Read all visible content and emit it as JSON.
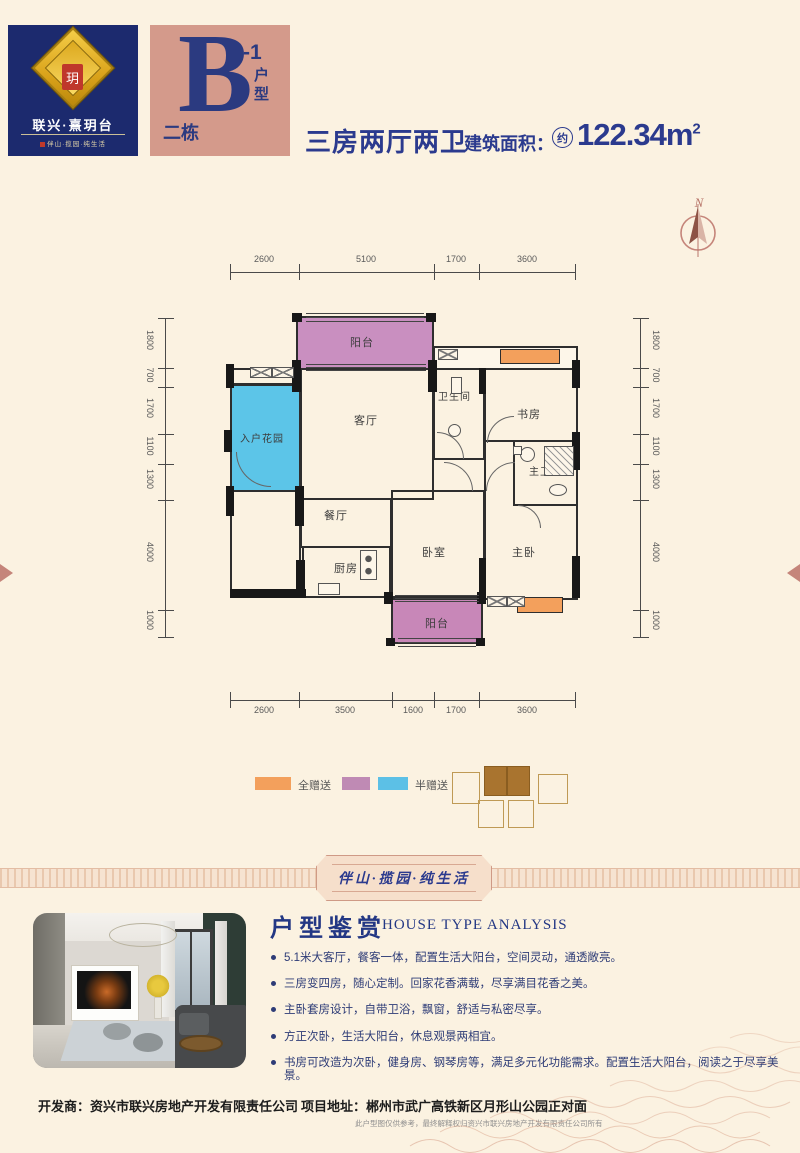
{
  "brand": {
    "name": "联兴·熹玥台",
    "tagline": "伴山·揽园·纯生活",
    "emblem_char": "玥"
  },
  "unit_badge": {
    "building": "二栋",
    "letter": "B",
    "suffix": "-1",
    "type_label": "户型"
  },
  "header": {
    "rooms_title": "三房两厅两卫",
    "area_label": "建筑面积：",
    "area_approx": "约",
    "area_value": "122.34m",
    "area_sup": "2"
  },
  "compass": {
    "north": "N"
  },
  "plan": {
    "rooms": {
      "balcony_top": "阳台",
      "entry_garden": "入户花园",
      "living": "客厅",
      "bath": "卫生间",
      "study": "书房",
      "master_bath": "主卫",
      "dining": "餐厅",
      "kitchen": "厨房",
      "bedroom": "卧室",
      "master": "主卧",
      "balcony_bottom": "阳台"
    },
    "dims": {
      "top": [
        "2600",
        "5100",
        "1700",
        "3600"
      ],
      "bottom": [
        "2600",
        "3500",
        "1600",
        "1700",
        "3600"
      ],
      "left": [
        "1800",
        "700",
        "1700",
        "1100",
        "1300",
        "4000",
        "1000"
      ],
      "right": [
        "1800",
        "700",
        "1700",
        "1100",
        "1300",
        "4000",
        "1000"
      ]
    }
  },
  "legend": {
    "full": "全赠送",
    "half": "半赠送"
  },
  "banner": {
    "text": "伴山·揽园·纯生活"
  },
  "analysis": {
    "title": "户型鉴赏",
    "subtitle": "HOUSE TYPE ANALYSIS",
    "bullets": [
      "5.1米大客厅，餐客一体，配置生活大阳台，空间灵动，通透敞亮。",
      "三房变四房，随心定制。回家花香满载，尽享满目花香之美。",
      "主卧套房设计，自带卫浴，飘窗，舒适与私密尽享。",
      "方正次卧，生活大阳台，休息观景两相宜。",
      "书房可改造为次卧，健身房、钢琴房等，满足多元化功能需求。配置生活大阳台，阅读之于尽享美景。"
    ]
  },
  "footer": {
    "developer_label": "开发商：",
    "developer": "资兴市联兴房地产开发有限责任公司",
    "address_label": "项目地址：",
    "address": "郴州市武广高铁新区月形山公园正对面",
    "disclaimer": "此户型图仅供参考，最终解释权归资兴市联兴房地产开发有限责任公司所有"
  },
  "colors": {
    "navy": "#1c2a6e",
    "title_blue": "#2b3a8e",
    "salmon": "#d49a8b",
    "gift_orange": "#f3a05c",
    "gift_pink": "#c98fc0",
    "gift_blue": "#5cc5e8",
    "rose": "#c5857a",
    "background": "#fbf2e1"
  }
}
